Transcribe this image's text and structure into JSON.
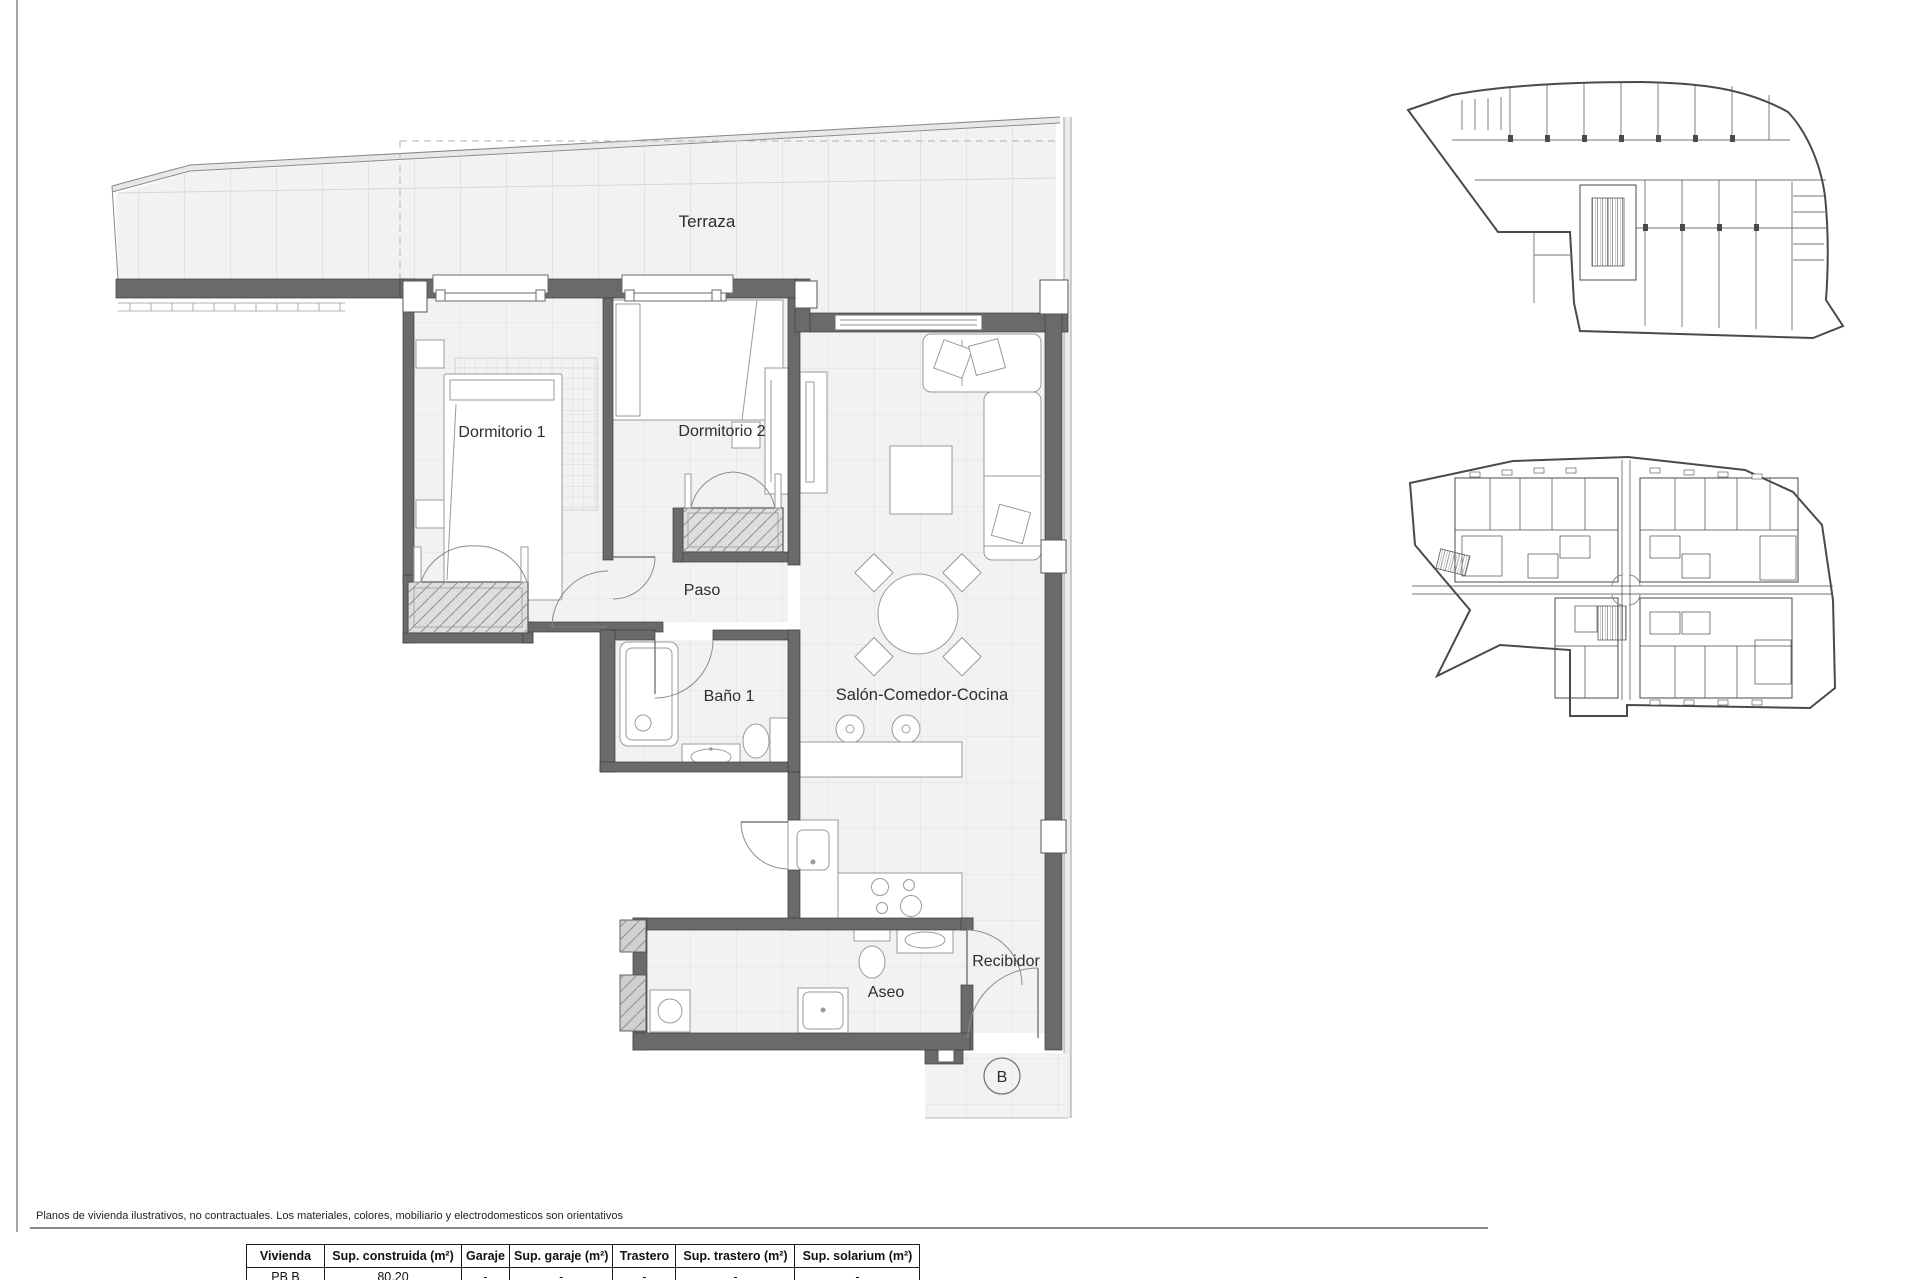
{
  "floorplan": {
    "rooms": {
      "terraza": "Terraza",
      "dormitorio1": "Dormitorio 1",
      "dormitorio2": "Dormitorio 2",
      "paso": "Paso",
      "bano1": "Baño 1",
      "salon": "Salón-Comedor-Cocina",
      "aseo": "Aseo",
      "recibidor": "Recibidor"
    },
    "unit_marker": "B"
  },
  "disclaimer": "Planos de vivienda ilustrativos, no contractuales. Los materiales, colores, mobiliario y electrodomesticos son orientativos",
  "table": {
    "headers": [
      "Vivienda",
      "Sup. construida (m²)",
      "Garaje",
      "Sup. garaje (m²)",
      "Trastero",
      "Sup. trastero (m²)",
      "Sup. solarium (m²)"
    ],
    "rows": [
      [
        "PB B",
        "80.20",
        "-",
        "-",
        "-",
        "-",
        "-"
      ]
    ]
  },
  "colors": {
    "wall": "#6a6a6a",
    "floor": "#f2f2f2",
    "grid_line": "#e0e0e0",
    "drawing_line": "#4a4a4a",
    "text": "#2d2d2d",
    "background": "#ffffff"
  }
}
